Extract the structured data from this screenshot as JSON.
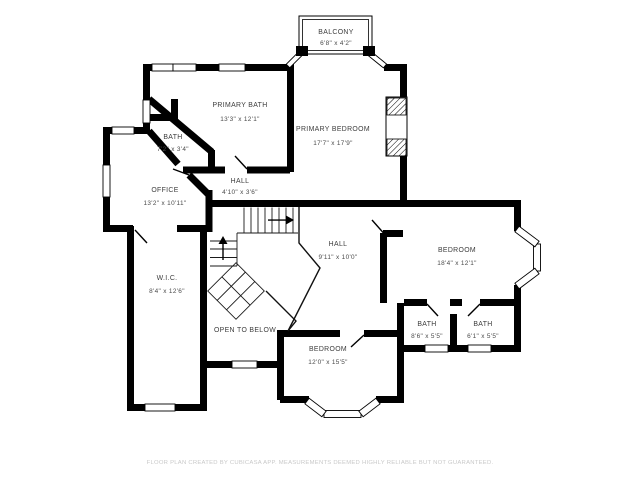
{
  "page": {
    "background": "#ffffff",
    "wall_color": "#000000"
  },
  "rooms": [
    {
      "id": "balcony",
      "name": "BALCONY",
      "dims": "6'8\" x 4'2\""
    },
    {
      "id": "primary-bath",
      "name": "PRIMARY BATH",
      "dims": "13'3\" x 12'1\""
    },
    {
      "id": "bath-small",
      "name": "BATH",
      "dims": "7'2\" x 3'4\""
    },
    {
      "id": "primary-bedroom",
      "name": "PRIMARY BEDROOM",
      "dims": "17'7\" x 17'9\""
    },
    {
      "id": "office",
      "name": "OFFICE",
      "dims": "13'2\" x 10'11\""
    },
    {
      "id": "hall-upper",
      "name": "HALL",
      "dims": "4'10\" x 3'6\""
    },
    {
      "id": "hall-center",
      "name": "HALL",
      "dims": "9'11\" x 10'0\""
    },
    {
      "id": "bedroom-right",
      "name": "BEDROOM",
      "dims": "18'4\" x 12'1\""
    },
    {
      "id": "wic",
      "name": "W.I.C.",
      "dims": "8'4\" x 12'6\""
    },
    {
      "id": "open-to-below",
      "name": "OPEN TO BELOW",
      "dims": ""
    },
    {
      "id": "bedroom-bottom",
      "name": "BEDROOM",
      "dims": "12'0\" x 15'5\""
    },
    {
      "id": "bath-left",
      "name": "BATH",
      "dims": "8'6\" x 5'5\""
    },
    {
      "id": "bath-right",
      "name": "BATH",
      "dims": "6'1\" x 5'5\""
    }
  ],
  "footer": {
    "text": "FLOOR PLAN CREATED BY CUBICASA APP. MEASUREMENTS DEEMED HIGHLY RELIABLE BUT NOT GUARANTEED."
  }
}
